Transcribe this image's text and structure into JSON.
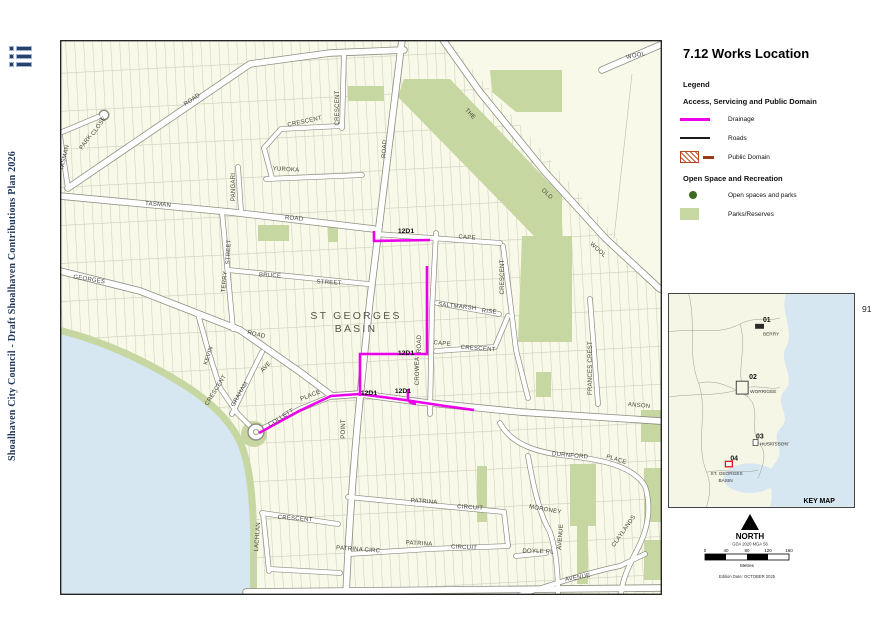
{
  "page": {
    "number": "91"
  },
  "sidebar": {
    "doc_title": "Shoalhaven City Council - Draft Shoalhaven Contributions Plan 2026"
  },
  "panel": {
    "title": "7.12 Works Location",
    "legend_heading": "Legend",
    "group1_heading": "Access, Servicing and Public Domain",
    "item_drainage": "Drainage",
    "item_roads": "Roads",
    "item_public_domain": "Public Domain",
    "group2_heading": "Open Space and Recreation",
    "item_open_spaces": "Open spaces and parks",
    "item_parks": "Parks/Reserves"
  },
  "key_map": {
    "label": "KEY MAP",
    "p1_id": "01",
    "p1_name": "BERRY",
    "p2_id": "02",
    "p2_name": "WORRIGEE",
    "p3_id": "03",
    "p3_name": "HUSKISSON",
    "p4_id": "04",
    "p4_name_line1": "ST. GEORGES",
    "p4_name_line2": "BASIN"
  },
  "north": {
    "label": "NORTH",
    "datum": "GDA 2020 MGA 56"
  },
  "scale": {
    "ticks": [
      "0",
      "40",
      "80",
      "120",
      "160"
    ],
    "unit": "Metres"
  },
  "edition": "Edition Date: OCTOBER 2025",
  "map": {
    "place_line1": "ST GEORGES",
    "place_line2": "BASIN",
    "works": [
      "12D1",
      "12D1",
      "12D1",
      "12D1"
    ],
    "streets": [
      "TASMAN",
      "PARK",
      "CLOSE",
      "ROAD",
      "TASMAN",
      "ROAD",
      "CRESCENT",
      "CRESCENT",
      "YUROKA",
      "PANGARI",
      "STREET",
      "TERRY",
      "BRUCE",
      "STREET",
      "GEORGES",
      "ROAD",
      "KEVIN",
      "CRESCENT",
      "GRAHAM",
      "AVE",
      "COLLETT",
      "PLACE",
      "POINT",
      "ROAD",
      "CROWEA",
      "ROAD",
      "CAPE",
      "CRESCENT",
      "SALTMARSH",
      "RISE",
      "CAPE",
      "CRESCENT",
      "FRANCES CREST",
      "ANSON",
      "THE",
      "OLD",
      "WOOL",
      "WOOL",
      "DURNFORD",
      "PLACE",
      "MORONEY",
      "AVENUE",
      "DOYLE PL",
      "AVENUE",
      "CLAYLANDS",
      "PATRINA",
      "CIRCUIT",
      "PATRINA",
      "CIRCUIT",
      "PATRINA CIRC.",
      "CRESCENT",
      "LACHLAN"
    ],
    "colors": {
      "drainage": "#EC00EC",
      "parks": "#C7D7A1",
      "water": "#D7E7F2",
      "open_space_dot": "#3F6B1F",
      "public_domain": "#B5431B",
      "sidebar_navy": "#20395E"
    }
  }
}
